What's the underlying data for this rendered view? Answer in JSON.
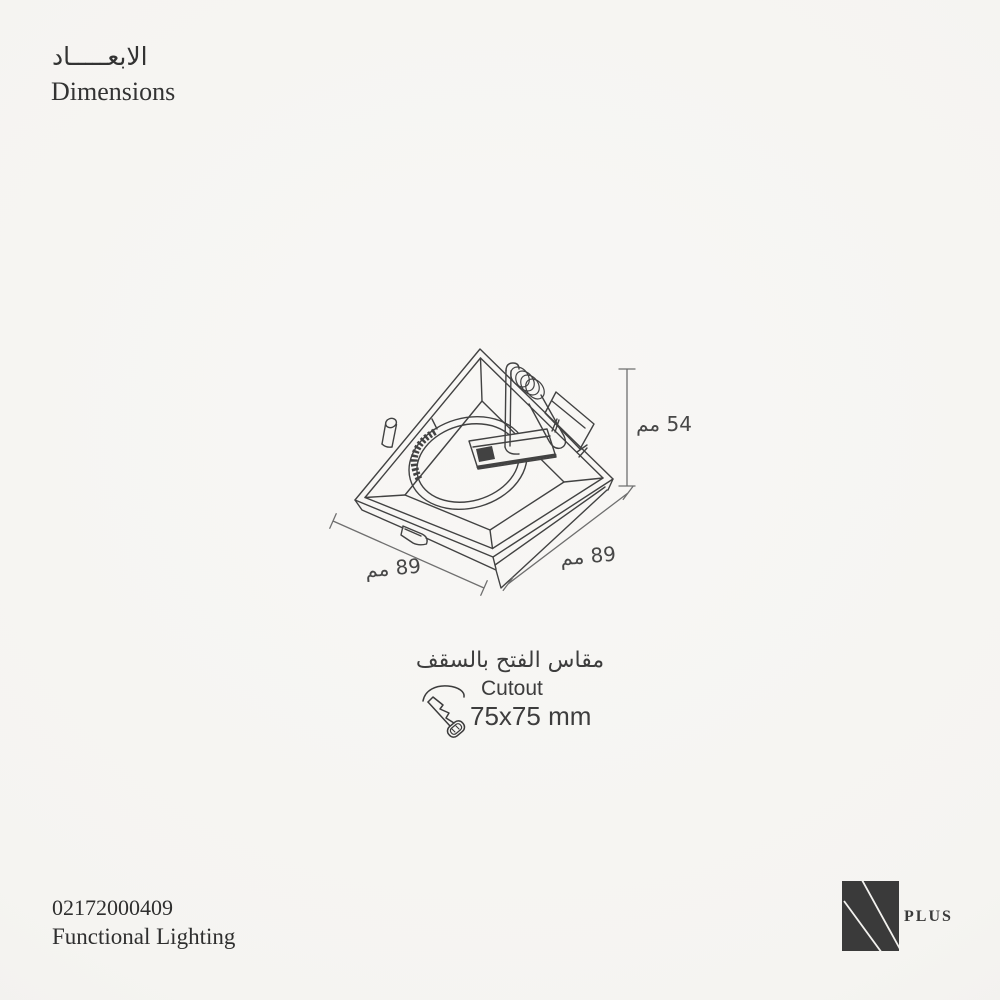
{
  "colors": {
    "paper": "#f6f5f2",
    "ink": "#3a3a3a",
    "drawing_line": "#424242",
    "dimension_line": "#6f6f6f",
    "logo": "#3a3a3a"
  },
  "header": {
    "title_ar": "الابعـــــاد",
    "title_en": "Dimensions"
  },
  "diagram": {
    "type": "isometric technical drawing of square recessed gimbal downlight",
    "height_label": "54 مم",
    "width_label": "89 مم",
    "depth_label": "89 مم"
  },
  "cutout": {
    "title_ar": "مقاس الفتح بالسقف",
    "title_en": "Cutout",
    "size": "75x75 mm"
  },
  "footer": {
    "product_code": "02172000409",
    "product_line": "Functional Lighting"
  },
  "logo": {
    "mark": "N",
    "text": "PLUS"
  }
}
